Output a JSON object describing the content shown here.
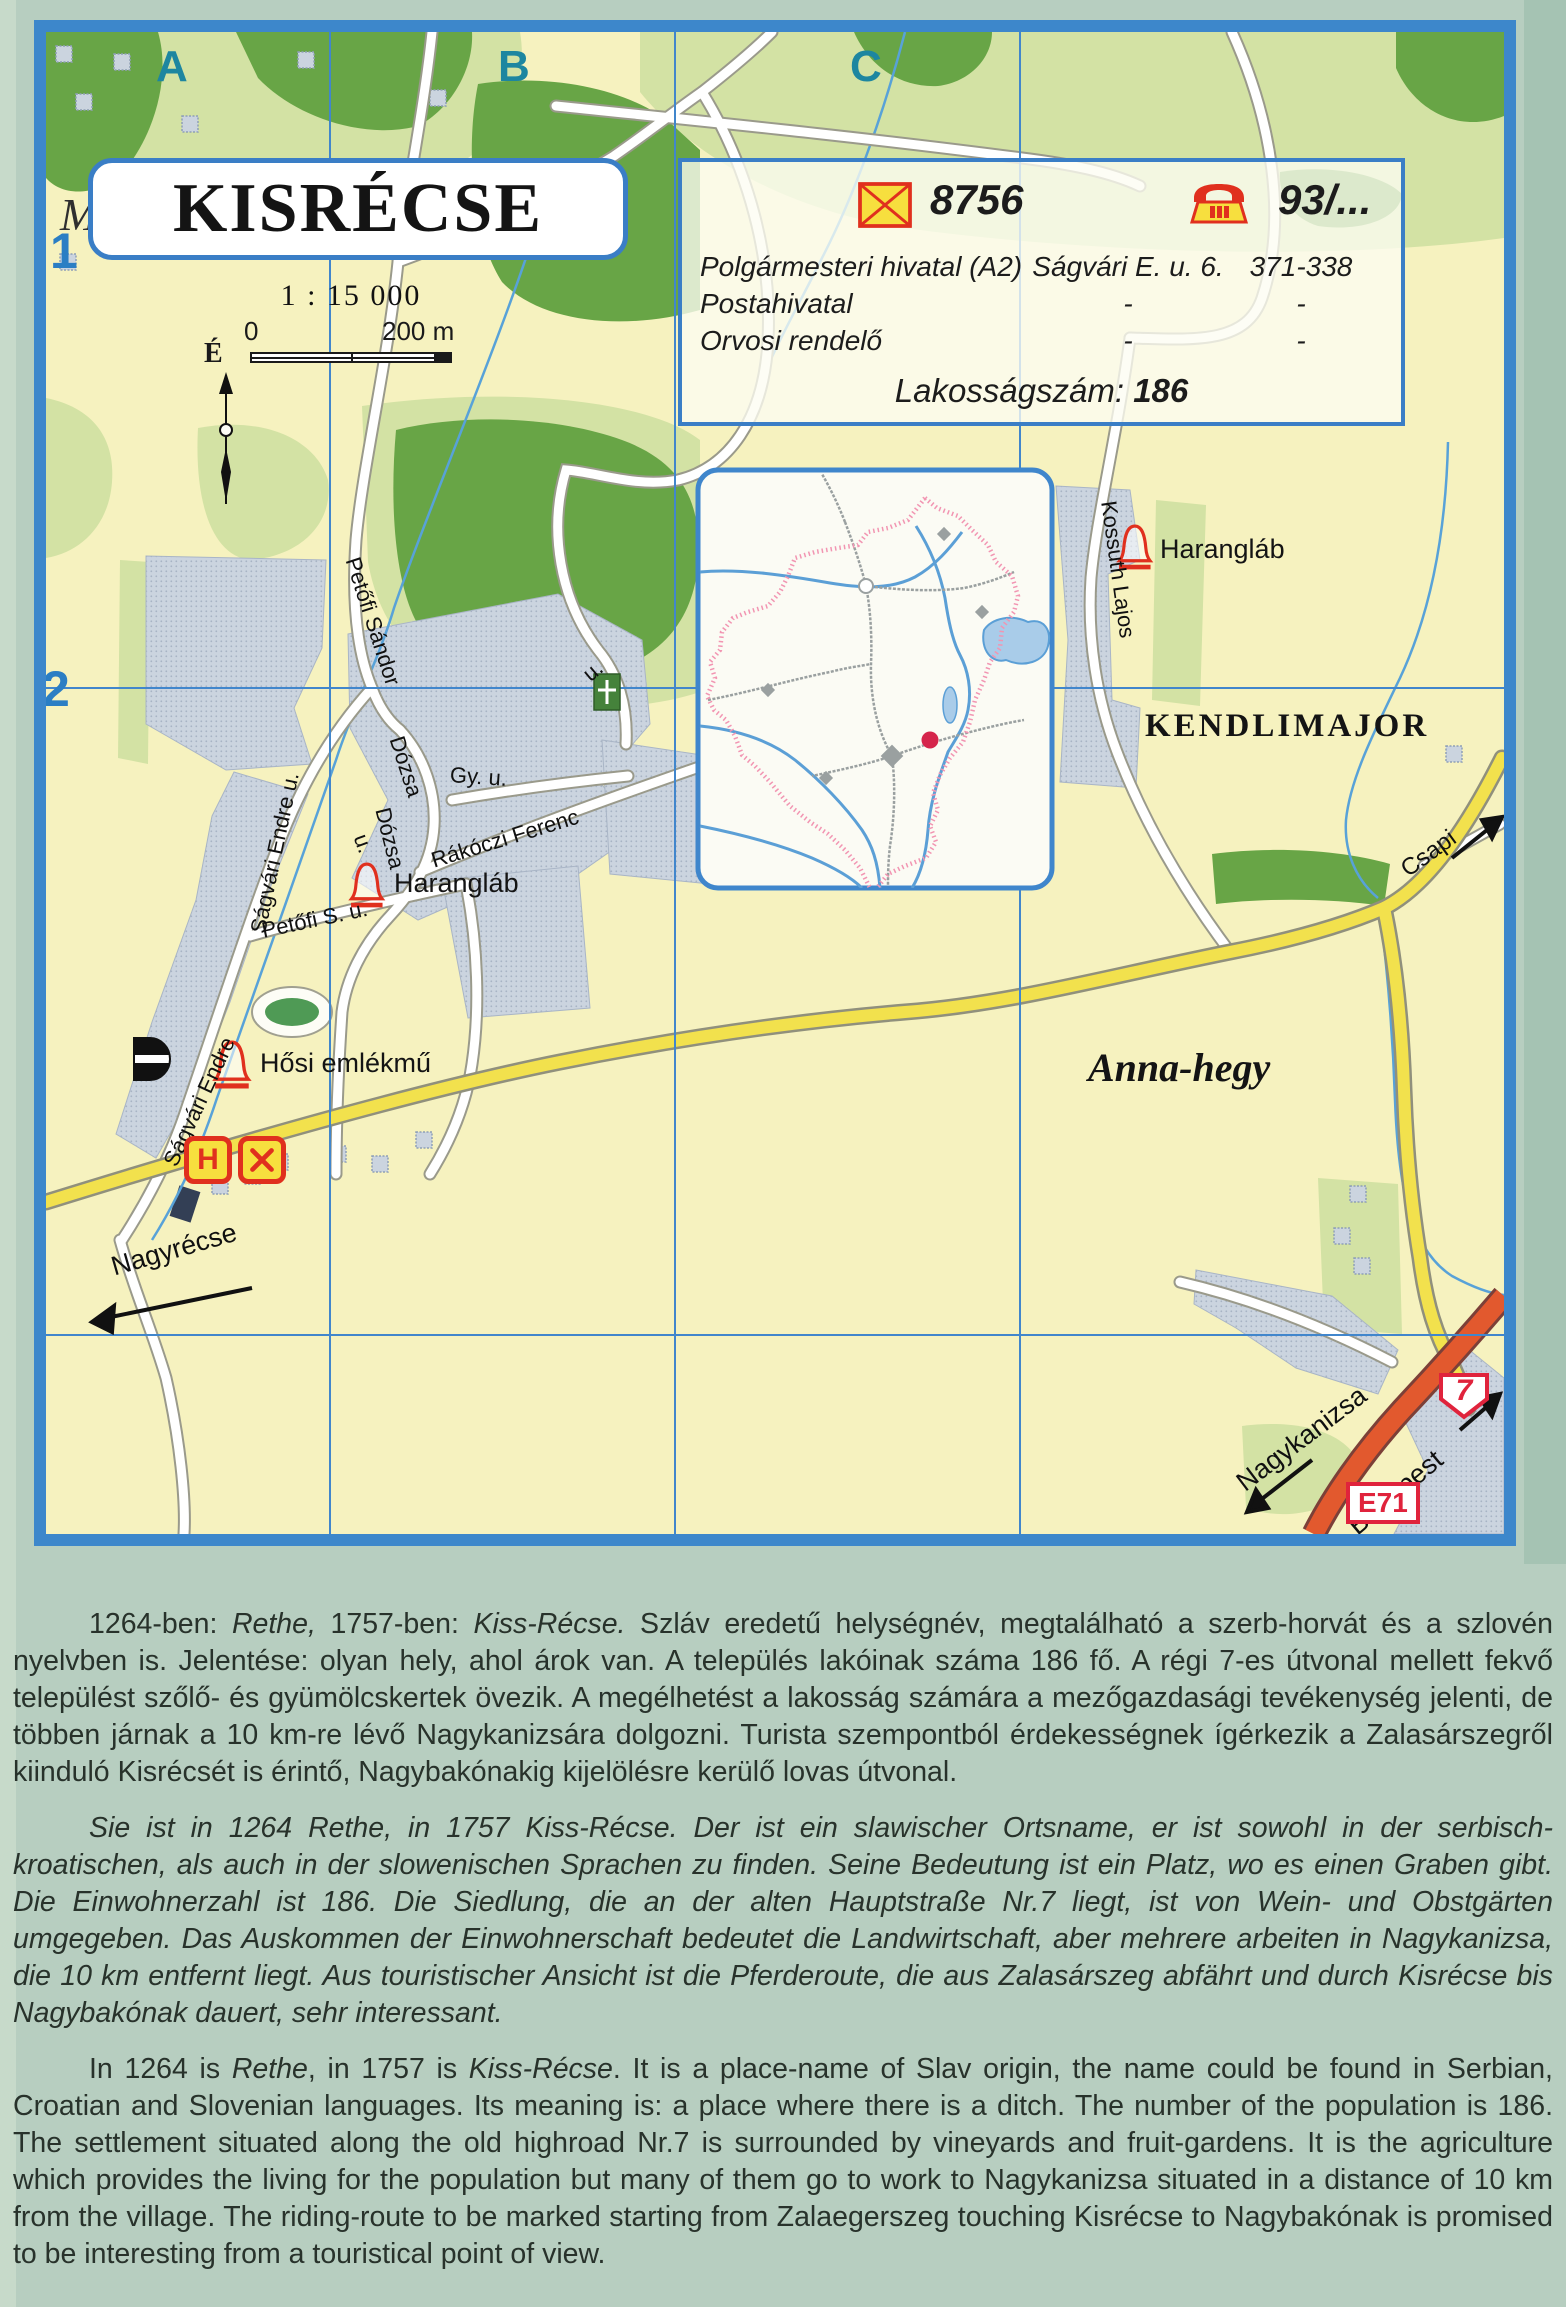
{
  "page": {
    "background": "#b7cec0"
  },
  "map": {
    "title": "KISRÉCSE",
    "ghost_letter": "M",
    "scale": {
      "ratio": "1 : 15 000",
      "zero": "0",
      "end": "200 m"
    },
    "north_label": "É",
    "grid": {
      "columns": [
        "A",
        "B",
        "C"
      ],
      "rows": [
        "1",
        "2"
      ]
    },
    "info_box": {
      "postal_code": "8756",
      "phone_code": "93/...",
      "rows": [
        {
          "name": "Polgármesteri hivatal (A2)",
          "address": "Ságvári E. u. 6.",
          "phone": "371-338"
        },
        {
          "name": "Postahivatal",
          "address": "-",
          "phone": "-"
        },
        {
          "name": "Orvosi rendelő",
          "address": "-",
          "phone": "-"
        }
      ],
      "population_label": "Lakosságszám:",
      "population_value": "186"
    },
    "labels": {
      "kendlimajor": "KENDLIMAJOR",
      "haranglab_north": "Harangláb",
      "haranglab_village": "Harangláb",
      "hosi_emlekmu": "Hősi emlékmű",
      "anna_hegy": "Anna-hegy",
      "hotel_letter": "H",
      "route_7": "7",
      "route_e71": "E71"
    },
    "directions": {
      "nagyrecse": "Nagyrécse",
      "csapi": "Csapi",
      "nagykanizsa": "Nagykanizsa",
      "budapest": "Budapest"
    },
    "streets": [
      {
        "text": "Petőfi Sándor"
      },
      {
        "text": "Ságvári Endre u."
      },
      {
        "text": "Ságvári Endre"
      },
      {
        "text": "Petőfi S. u."
      },
      {
        "text": "Dózsa"
      },
      {
        "text": "Gy. u."
      },
      {
        "text": "Dózsa"
      },
      {
        "text": "u."
      },
      {
        "text": "Rákóczi Ferenc"
      },
      {
        "text": "Kossuth Lajos"
      },
      {
        "text": "u."
      }
    ],
    "icons": [
      "envelope-icon",
      "phone-icon",
      "bell-icon",
      "monument-icon",
      "hotel-icon",
      "restaurant-icon",
      "north-arrow-icon",
      "church-cross-icon",
      "location-dot-icon",
      "direction-arrow-icon"
    ],
    "colors": {
      "map_border_blue": "#3d87cb",
      "grid_blue": "#4186cc",
      "terrain_yellow": "#f6f2bf",
      "forest_green": "#68a546",
      "light_green": "#d3e2a4",
      "built_up_gray": "#cbd4df",
      "road_yellow": "#f2e14d",
      "highway_orange": "#e2592e",
      "icon_red": "#e0301e",
      "icon_yellow": "#f7df3e",
      "boundary_pink": "#f295b2",
      "grid_letter_teal": "#1d86a0",
      "grid_number_blue": "#2b7ec4"
    }
  },
  "text_section": {
    "hungarian": {
      "parts": [
        "1264-ben: ",
        "Rethe,",
        " 1757-ben: ",
        "Kiss-Récse.",
        " Szláv eredetű helységnév, megtalálható a szerb-horvát és a szlovén nyelvben is. Jelentése: olyan hely, ahol árok van. A település lakóinak száma 186 fő. A régi 7-es útvonal mellett fekvő települést szőlő- és gyümölcskertek övezik. A megélhetést a lakosság számára a mezőgazdasági tevékenység jelenti, de többen járnak a 10 km-re lévő Nagykanizsára dolgozni. Turista szempontból érdekességnek ígérkezik a Zalasárszegről kiinduló Kisrécsét is érintő, Nagybakónakig kijelölésre kerülő lovas útvonal."
      ]
    },
    "german": {
      "text": "Sie ist in 1264 Rethe, in 1757 Kiss-Récse. Der ist ein slawischer Ortsname, er ist sowohl in der serbisch-kroatischen, als auch in der slowenischen Sprachen zu finden. Seine Bedeutung ist ein Platz, wo es einen Graben gibt. Die Einwohnerzahl ist 186. Die Siedlung, die an der alten Hauptstraße Nr.7 liegt, ist von Wein- und Obstgärten umgegeben. Das Auskommen der Einwohnerschaft bedeutet die Landwirtschaft, aber mehrere arbeiten in Nagykanizsa, die 10 km entfernt liegt. Aus touristischer Ansicht ist die Pferderoute, die aus Zalasárszeg abfährt und durch Kisrécse bis Nagybakónak dauert, sehr interessant."
    },
    "english": {
      "parts": [
        "In 1264 is ",
        "Rethe",
        ", in 1757 is ",
        "Kiss-Récse",
        ". It is a place-name of Slav origin, the name could be found in Serbian, Croatian and Slovenian languages. Its meaning is: a place where there is a ditch. The number of the population is 186. The settlement situated along the old highroad Nr.7 is surrounded by vineyards and fruit-gardens. It is the agriculture which provides the living for the population but many of them go to work to Nagykanizsa situated in a distance of 10 km from the village. The riding-route to be marked starting from Zalaegerszeg touching Kisrécse to Nagybakónak is promised to be interesting from a touristical point of view."
      ]
    }
  }
}
